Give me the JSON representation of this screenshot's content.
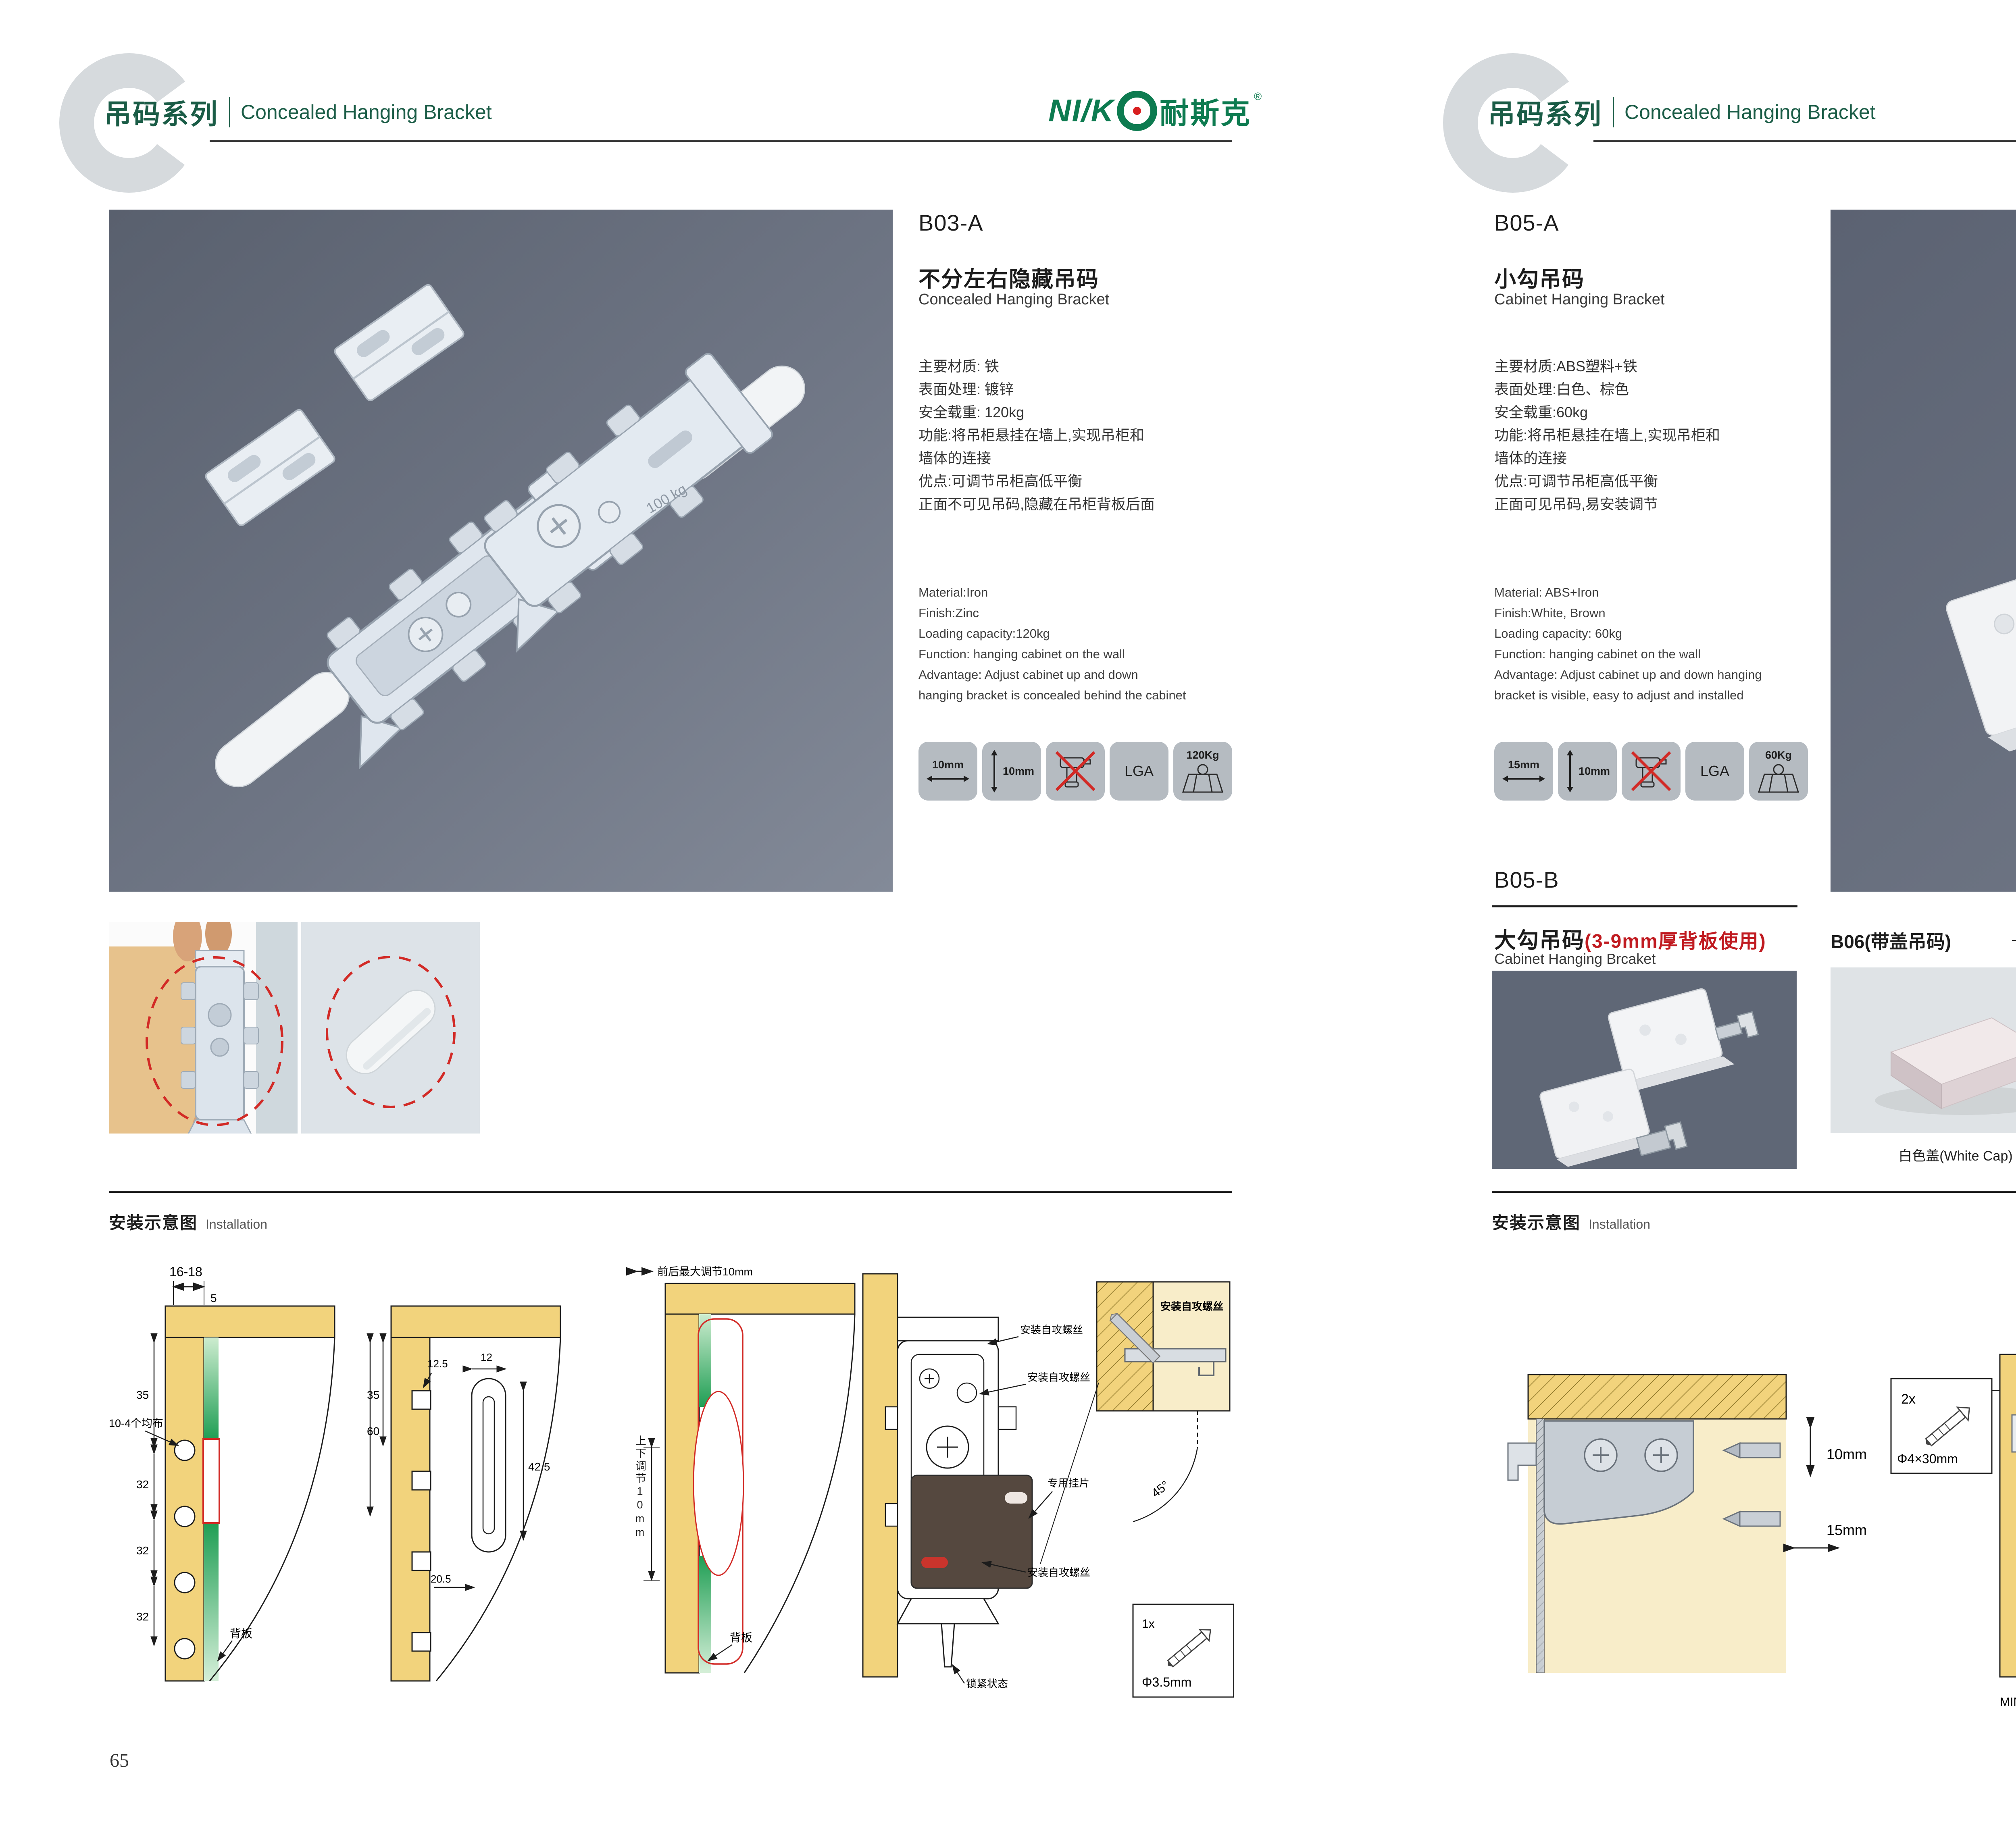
{
  "colors": {
    "brand_green": "#1a5c46",
    "logo_green": "#0d7b50",
    "accent_red": "#d22a26",
    "photo_slate": "#6e7584",
    "wood_yellow": "#f2d37c",
    "badge_gray": "#b5bbc1"
  },
  "brand": {
    "latin": "NI/K",
    "cn": "耐斯克",
    "reg": "®"
  },
  "header": {
    "letter": "C",
    "series_cn": "吊码系列",
    "series_en": "Concealed Hanging Bracket"
  },
  "left_page": {
    "page_number": "65",
    "product": {
      "code": "B03-A",
      "name_cn": "不分左右隐藏吊码",
      "name_en": "Concealed Hanging Bracket",
      "specs_cn": [
        "主要材质: 铁",
        "表面处理: 镀锌",
        "安全载重: 120kg",
        "功能:将吊柜悬挂在墙上,实现吊柜和",
        "墙体的连接",
        "优点:可调节吊柜高低平衡",
        "正面不可见吊码,隐藏在吊柜背板后面"
      ],
      "specs_en": [
        "Material:Iron",
        "Finish:Zinc",
        "Loading capacity:120kg",
        "Function: hanging cabinet on the wall",
        "Advantage: Adjust cabinet up and down",
        "hanging bracket is concealed behind the cabinet"
      ],
      "badges": {
        "w": "10mm",
        "h": "10mm",
        "cert": "LGA",
        "load": "120Kg"
      },
      "photo_stamp": "100 kg"
    },
    "installation": {
      "title_cn": "安装示意图",
      "title_en": "Installation",
      "d1": {
        "dim_top": "16-18",
        "dim_5": "5",
        "dim_35": "35",
        "dim_32a": "32",
        "dim_32b": "32",
        "dim_32c": "32",
        "holes_note": "10-4个均布",
        "backboard": "背板"
      },
      "d2": {
        "dim_60": "60",
        "dim_35": "35",
        "dim_125": "12.5",
        "dim_12": "12",
        "dim_425": "42.5",
        "dim_205": "20.5"
      },
      "d3": {
        "top_note": "前后最大调节10mm",
        "side_note": "上下调节10mm",
        "backboard": "背板"
      },
      "d4": {
        "screw1": "安装自攻螺丝",
        "screw2": "安装自攻螺丝",
        "plate": "专用挂片",
        "screw3": "安装自攻螺丝",
        "lock": "锁紧状态"
      },
      "detail": {
        "screw_note": "安装自攻螺丝",
        "angle": "45°",
        "qty": "1x",
        "size": "Φ3.5mm"
      }
    }
  },
  "right_page": {
    "page_number": "66",
    "product": {
      "code": "B05-A",
      "name_cn": "小勾吊码",
      "name_en": "Cabinet Hanging Bracket",
      "specs_cn": [
        "主要材质:ABS塑料+铁",
        "表面处理:白色、棕色",
        "安全载重:60kg",
        "功能:将吊柜悬挂在墙上,实现吊柜和",
        "墙体的连接",
        "优点:可调节吊柜高低平衡",
        "正面可见吊码,易安装调节"
      ],
      "specs_en": [
        "Material: ABS+Iron",
        "Finish:White, Brown",
        "Loading capacity: 60kg",
        "Function: hanging cabinet on the wall",
        "Advantage: Adjust cabinet up and down hanging",
        "bracket is visible, easy to adjust and installed"
      ],
      "badges": {
        "w": "15mm",
        "h": "10mm",
        "cert": "LGA",
        "load": "60Kg"
      }
    },
    "product_b": {
      "code": "B05-B",
      "name_cn": "大勾吊码",
      "name_red": "(3-9mm厚背板使用)",
      "name_en": "Cabinet Hanging Brcaket"
    },
    "product_c": {
      "title": "B06(带盖吊码)",
      "caps": [
        "白色盖(White Cap)",
        "灰色盖(Gray Cap)",
        "银色盖(Silver Cap)"
      ]
    },
    "installation": {
      "title_cn": "安装示意图",
      "title_en": "Installation",
      "d1": {
        "v": "10mm",
        "h": "15mm"
      },
      "screwbox": {
        "qty": "2x",
        "size": "Φ4×30mm"
      },
      "d2": {
        "dim_18": "18",
        "min": "MIN.10",
        "max": "MAX.23",
        "dim_58": "58"
      },
      "d3": {
        "dim_16t": "16",
        "dim_42": "42",
        "rmax": "RMAX4",
        "dim_16b": "16",
        "dim_17": "17",
        "dim_32": "32"
      }
    }
  }
}
